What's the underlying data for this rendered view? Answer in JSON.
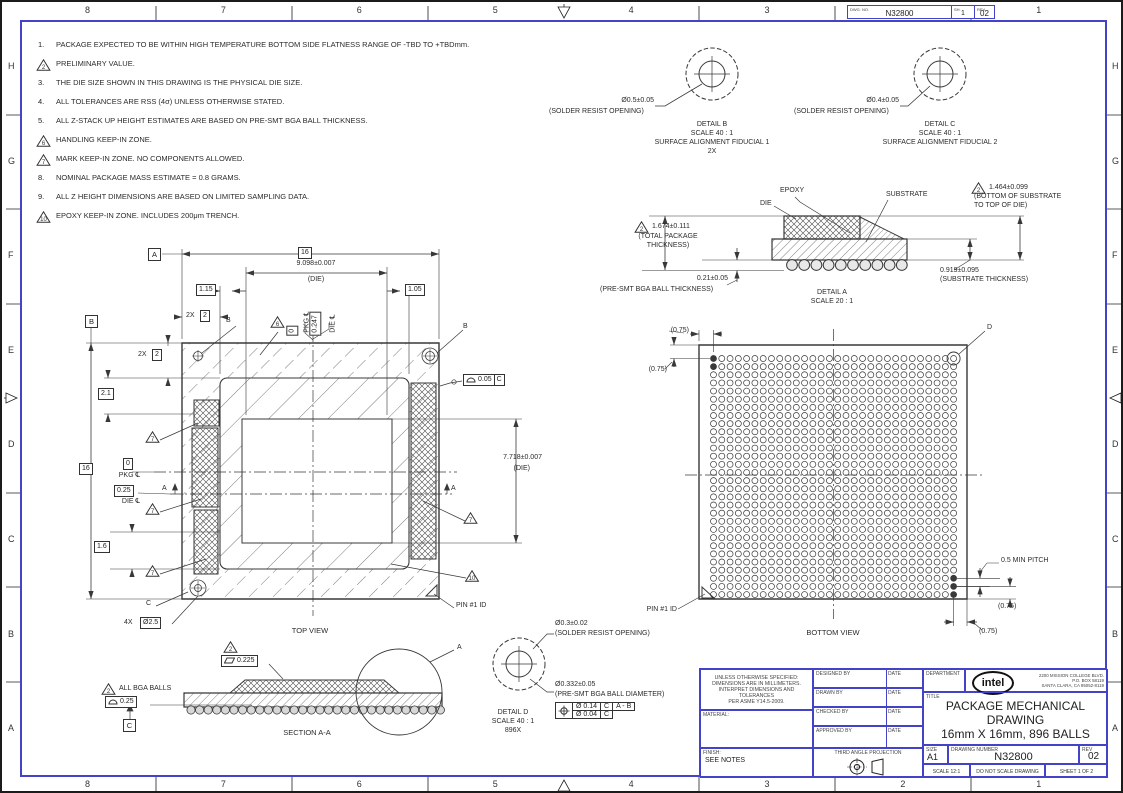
{
  "colors": {
    "frame_blue": "#4343c8",
    "line": "#383838",
    "text": "#2b2b2b"
  },
  "border": {
    "top_numbers": [
      "8",
      "7",
      "6",
      "5",
      "4",
      "3",
      "2",
      "1"
    ],
    "side_letters": [
      "H",
      "G",
      "F",
      "E",
      "D",
      "C",
      "B",
      "A"
    ],
    "dwg_strip": {
      "label": "DWG. NO.",
      "value": "N32800",
      "sh_label": "SH.",
      "sh": "1",
      "rev_label": "REV.",
      "rev": "02"
    }
  },
  "notes": [
    {
      "n": "1.",
      "flag": false,
      "text": "PACKAGE EXPECTED TO BE WITHIN HIGH TEMPERATURE BOTTOM SIDE FLATNESS RANGE OF -TBD TO +TBDmm."
    },
    {
      "n": "2",
      "flag": true,
      "text": "PRELIMINARY VALUE."
    },
    {
      "n": "3.",
      "flag": false,
      "text": "THE DIE SIZE SHOWN IN THIS DRAWING IS THE PHYSICAL DIE SIZE."
    },
    {
      "n": "4.",
      "flag": false,
      "text": "ALL TOLERANCES ARE RSS (4σ) UNLESS OTHERWISE STATED."
    },
    {
      "n": "5.",
      "flag": false,
      "text": "ALL Z-STACK UP HEIGHT ESTIMATES ARE BASED ON PRE-SMT BGA BALL THICKNESS."
    },
    {
      "n": "6",
      "flag": true,
      "text": "HANDLING KEEP-IN ZONE."
    },
    {
      "n": "7",
      "flag": true,
      "text": "MARK KEEP-IN ZONE. NO COMPONENTS ALLOWED."
    },
    {
      "n": "8.",
      "flag": false,
      "text": "NOMINAL PACKAGE MASS ESTIMATE = 0.8 GRAMS."
    },
    {
      "n": "9.",
      "flag": false,
      "text": "ALL Z HEIGHT DIMENSIONS ARE BASED ON LIMITED SAMPLING DATA."
    },
    {
      "n": "10",
      "flag": true,
      "text": "EPOXY KEEP-IN ZONE. INCLUDES 200μm TRENCH."
    }
  ],
  "flags": {
    "f2": "2",
    "f6": "6",
    "f7": "7",
    "f10": "10"
  },
  "detail_b": {
    "dim": "Ø0.5±0.05",
    "dim_note": "(SOLDER RESIST OPENING)",
    "name": "DETAIL B",
    "scale": "SCALE 40 : 1",
    "caption": "SURFACE ALIGNMENT FIDUCIAL 1",
    "qty": "2X"
  },
  "detail_c": {
    "dim": "Ø0.4±0.05",
    "dim_note": "(SOLDER RESIST OPENING)",
    "name": "DETAIL C",
    "scale": "SCALE 40 : 1",
    "caption": "SURFACE ALIGNMENT FIDUCIAL 2"
  },
  "detail_a": {
    "epoxy": "EPOXY",
    "die": "DIE",
    "substrate": "SUBSTRATE",
    "total": "1.674±0.111",
    "total_note": "(TOTAL PACKAGE\nTHICKNESS)",
    "bsd": "1.464±0.099",
    "bsd_note": "(BOTTOM OF SUBSTRATE\nTO TOP OF DIE)",
    "ball": "0.21±0.05",
    "ball_note": "(PRE-SMT BGA BALL THICKNESS)",
    "sub": "0.919±0.095",
    "sub_note": "(SUBSTRATE THICKNESS)",
    "name": "DETAIL A",
    "scale": "SCALE 20 : 1",
    "ball_count": 10
  },
  "top_view": {
    "pkg_size": "16",
    "die_w": "9.098±0.007",
    "die_note": "(DIE)",
    "die_h": "7.718±0.007",
    "off_l": "1.15",
    "off_r": "1.05",
    "qty2x": "2X",
    "basic2": "2",
    "d21": "2.1",
    "d16": "1.6",
    "zero": "0",
    "pkg_cl": "PKG ℄",
    "d025": "0.25",
    "die_cl": "DIE ℄",
    "d0247": "0.247",
    "corner_qty": "4X",
    "corner_dia": "Ø2.5",
    "prof_tol": "0.05",
    "datum_a": "A",
    "datum_b": "B",
    "datum_c": "C",
    "sec_a": "A",
    "ref_b": "B",
    "pin1": "PIN #1 ID",
    "caption": "TOP VIEW"
  },
  "bottom_view": {
    "ref075": "(0.75)",
    "pitch": "0.5 MIN PITCH",
    "pin1": "PIN #1 ID",
    "caption": "BOTTOM VIEW",
    "detail_ref": "D",
    "grid": {
      "rows": 30,
      "cols": 30
    }
  },
  "section_aa": {
    "flat": "0.225",
    "all_balls": "ALL BGA BALLS",
    "prof": "0.25",
    "datum_c": "C",
    "caption": "SECTION A-A",
    "detail_ref": "A",
    "ball_count": 30
  },
  "detail_d": {
    "sro": "Ø0.3±0.02",
    "sro_note": "(SOLDER RESIST OPENING)",
    "ball_dia": "Ø0.332±0.05",
    "ball_note": "(PRE-SMT BGA BALL DIAMETER)",
    "fcf": {
      "r1a": "Ø 0.14",
      "r1b": "C",
      "r1c": "A - B",
      "r2a": "Ø 0.04",
      "r2b": "C"
    },
    "name": "DETAIL D",
    "scale": "SCALE 40 : 1",
    "qty": "896X"
  },
  "title_block": {
    "tolerance_note": "UNLESS OTHERWISE SPECIFIED:\nDIMENSIONS ARE IN MILLIMETERS.\nINTERPRET DIMENSIONS AND TOLERANCES\nPER ASME Y14.5-2009.",
    "material_label": "MATERIAL:",
    "finish_label": "FINISH:",
    "finish_value": "SEE NOTES",
    "rows": [
      {
        "label": "DESIGNED BY",
        "date_label": "DATE"
      },
      {
        "label": "DRAWN BY",
        "date_label": "DATE"
      },
      {
        "label": "CHECKED BY",
        "date_label": "DATE"
      },
      {
        "label": "APPROVED BY",
        "date_label": "DATE"
      }
    ],
    "third_angle": "THIRD ANGLE PROJECTION",
    "department_label": "DEPARTMENT",
    "brand": "intel",
    "address": "2200 MISSION COLLEGE BLVD.\nP.O. BOX 58119\nSANTA CLARA, CA 95052-8119",
    "title_label": "TITLE",
    "title": "PACKAGE MECHANICAL\nDRAWING\n16mm X 16mm, 896 BALLS",
    "size_label": "SIZE",
    "size": "A1",
    "dwg_label": "DRAWING NUMBER",
    "dwg": "N32800",
    "rev_label": "REV",
    "rev": "02",
    "scale": "SCALE   12:1",
    "no_scale": "DO NOT SCALE DRAWING",
    "sheet": "SHEET 1 OF 2"
  }
}
